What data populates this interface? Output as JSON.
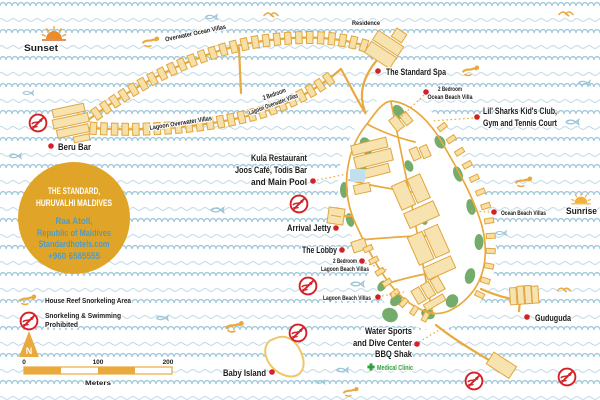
{
  "title": "The Standard, Huruvalhi Maldives — Resort Map",
  "colors": {
    "water_wave": "#A3CBDC",
    "water_wave_light": "#C2DCE9",
    "path_yellow": "#E9A93D",
    "building_fill": "#F7E0A6",
    "vegetation_green": "#74AC6C",
    "marker_red": "#D42127",
    "info_circle_gold": "#E0A528",
    "info_text_blue": "#4E9BC8",
    "clinic_green": "#2FA13B",
    "pool_blue": "#BEE0EF"
  },
  "info_circle": {
    "title_line1": "THE STANDARD,",
    "title_line2": "HURUVALHI MALDIVES",
    "address_line1": "Raa Atoll,",
    "address_line2": "Republic of Maldives",
    "website": "Standardhotels.com",
    "phone": "+960 6585555"
  },
  "compass": {
    "label": "N"
  },
  "scale_bar": {
    "tick_0": "0",
    "tick_100": "100",
    "tick_200": "200",
    "unit": "Meters"
  },
  "legend": {
    "house_reef": {
      "icon": "swimmer-icon",
      "label": "House Reef Snorkeling Area"
    },
    "prohibited": {
      "icon": "no-swimming-icon",
      "line1": "Snorkeling & Swimming",
      "line2": "Prohibited"
    }
  },
  "icons": {
    "sunset": "setting-sun-icon",
    "sunrise": "rising-sun-icon",
    "decorative": [
      "fish-icon",
      "swimmer-icon",
      "bird-icon"
    ]
  },
  "labels": {
    "sunset": "Sunset",
    "sunrise": "Sunrise",
    "beru_bar": "Beru Bar",
    "overwater_ocean_villas": "Overwater Ocean Villas",
    "lagoon_overwater_villas": "Lagoon Overwater Villas",
    "two_br_lagoon_overwater": {
      "line1": "2 Bedroom",
      "line2": "Lagoon Overwater Villas"
    },
    "residence": "Residence",
    "standard_spa": "The Standard Spa",
    "two_br_ocean_beach": {
      "line1": "2 Bedroom",
      "line2": "Ocean Beach Villa"
    },
    "lil_sharks": {
      "line1": "Lil' Sharks Kid's Club,",
      "line2": "Gym and Tennis Court"
    },
    "kula": {
      "line1": "Kula Restaurant",
      "line2": "Joos Café, Todis Bar",
      "line3": "and Main Pool"
    },
    "arrival_jetty": "Arrival Jetty",
    "the_lobby": "The Lobby",
    "two_br_lagoon_beach": {
      "line1": "2 Bedroom",
      "line2": "Lagoon Beach Villas"
    },
    "lagoon_beach_villas": "Lagoon Beach Villas",
    "ocean_beach_villas": "Ocean Beach Villas",
    "guduguda": "Guduguda",
    "water_sports": {
      "line1": "Water Sports",
      "line2": "and Dive Center",
      "line3": "BBQ Shak"
    },
    "medical_clinic": "Medical Clinic",
    "baby_island": "Baby Island"
  }
}
